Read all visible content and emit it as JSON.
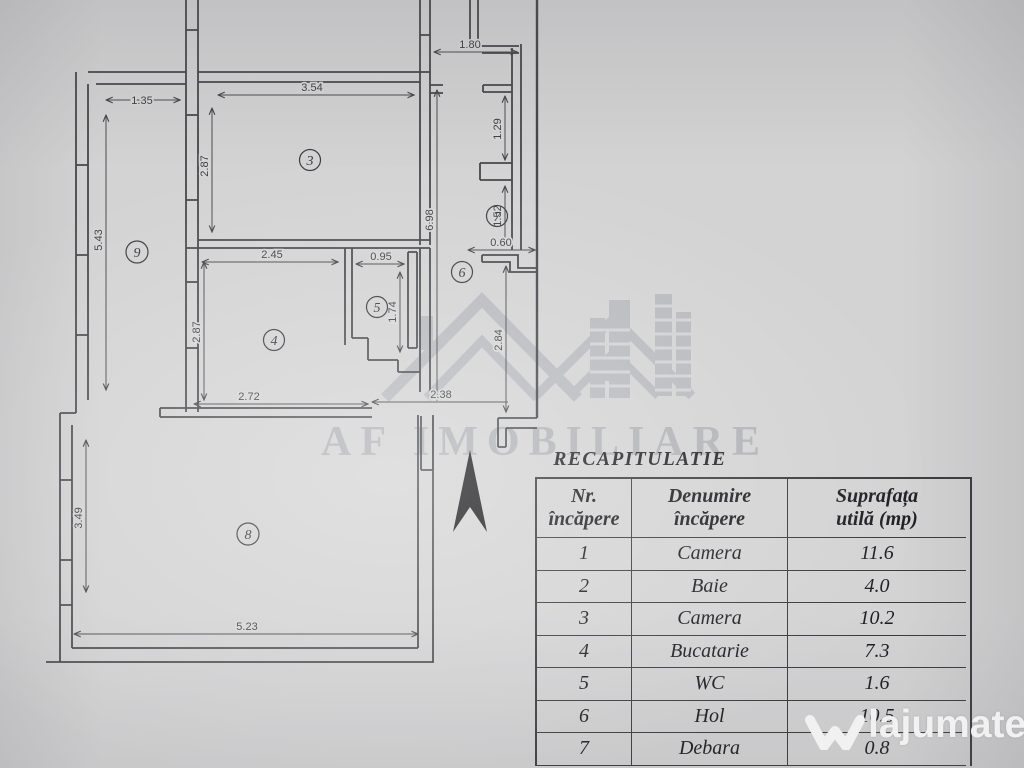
{
  "plan": {
    "rooms": [
      "3",
      "4",
      "5",
      "6",
      "7",
      "8",
      "9"
    ],
    "dims": {
      "balcony_top": "1.35",
      "balcony_left": "5.43",
      "room3_left": "2.87",
      "room3_top": "3.54",
      "hall_wall": "6.98",
      "room4_left": "2.87",
      "room4_top": "2.45",
      "wc_top": "0.95",
      "wc_right": "1.74",
      "room4_bottom": "2.72",
      "hall_bottom": "2.38",
      "hall_right": "2.84",
      "debara_upper": "1.29",
      "debara_lower": "1.52",
      "debara_door": "0.60",
      "top_right": "1.80",
      "room8_left": "3.49",
      "room8_bottom": "5.23"
    }
  },
  "watermark": {
    "brand": "AF IMOBILIARE"
  },
  "footer_watermark": {
    "brand": "lajumate",
    "tld": ".ro"
  },
  "table": {
    "title": "RECAPITULATIE",
    "headers": {
      "nr_line1": "Nr.",
      "nr_line2": "încăpere",
      "den_line1": "Denumire",
      "den_line2": "încăpere",
      "sup_line1": "Suprafața",
      "sup_line2": "utilă (mp)"
    },
    "rows": [
      {
        "nr": "1",
        "name": "Camera",
        "area": "11.6"
      },
      {
        "nr": "2",
        "name": "Baie",
        "area": "4.0"
      },
      {
        "nr": "3",
        "name": "Camera",
        "area": "10.2"
      },
      {
        "nr": "4",
        "name": "Bucatarie",
        "area": "7.3"
      },
      {
        "nr": "5",
        "name": "WC",
        "area": "1.6"
      },
      {
        "nr": "6",
        "name": "Hol",
        "area": "10.5"
      },
      {
        "nr": "7",
        "name": "Debara",
        "area": "0.8"
      }
    ]
  },
  "colors": {
    "paper": "#d3d3d4",
    "ink": "#44464a",
    "table_ink": "#1d1d22",
    "watermark_gray": "#8e939b"
  }
}
